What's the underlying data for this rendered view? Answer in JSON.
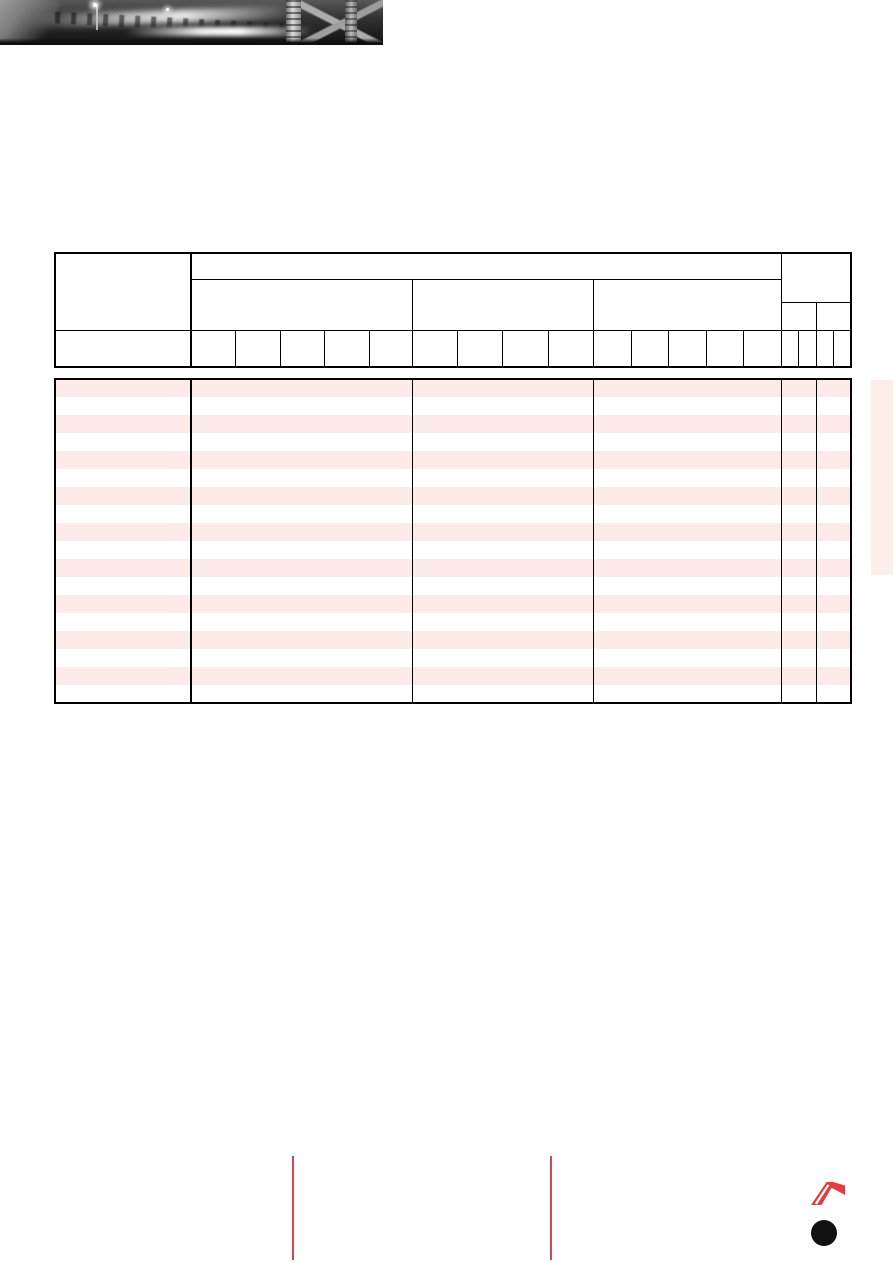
{
  "colors": {
    "table_border": "#000000",
    "row_stripe": "#fcebe8",
    "side_band": "#fdeee9",
    "footer_rule": "#cc4b4b",
    "logo_red": "#e23d41",
    "footer_dot": "#111111"
  },
  "header_photo": {
    "icon": "night-highway-photo"
  },
  "table": {
    "header": {
      "left_column": {
        "top": "",
        "bottom": ""
      },
      "top_row": "",
      "sections": [
        {
          "title": "",
          "subcolumns": [
            "",
            "",
            "",
            "",
            ""
          ]
        },
        {
          "title": "",
          "subcolumns": [
            "",
            "",
            "",
            ""
          ]
        },
        {
          "title": "",
          "subcolumns": [
            "",
            "",
            "",
            "",
            ""
          ]
        }
      ],
      "right_group": {
        "title": "",
        "mid_cells": [
          "",
          ""
        ],
        "subcolumns": [
          "",
          "",
          "",
          ""
        ]
      }
    },
    "body": {
      "row_count": 18,
      "column_count": 6,
      "cell_value": ""
    }
  },
  "footer": {
    "rule_count": 2,
    "logo_icon": "autostrade-a-logo",
    "dot_icon": "black-dot"
  }
}
